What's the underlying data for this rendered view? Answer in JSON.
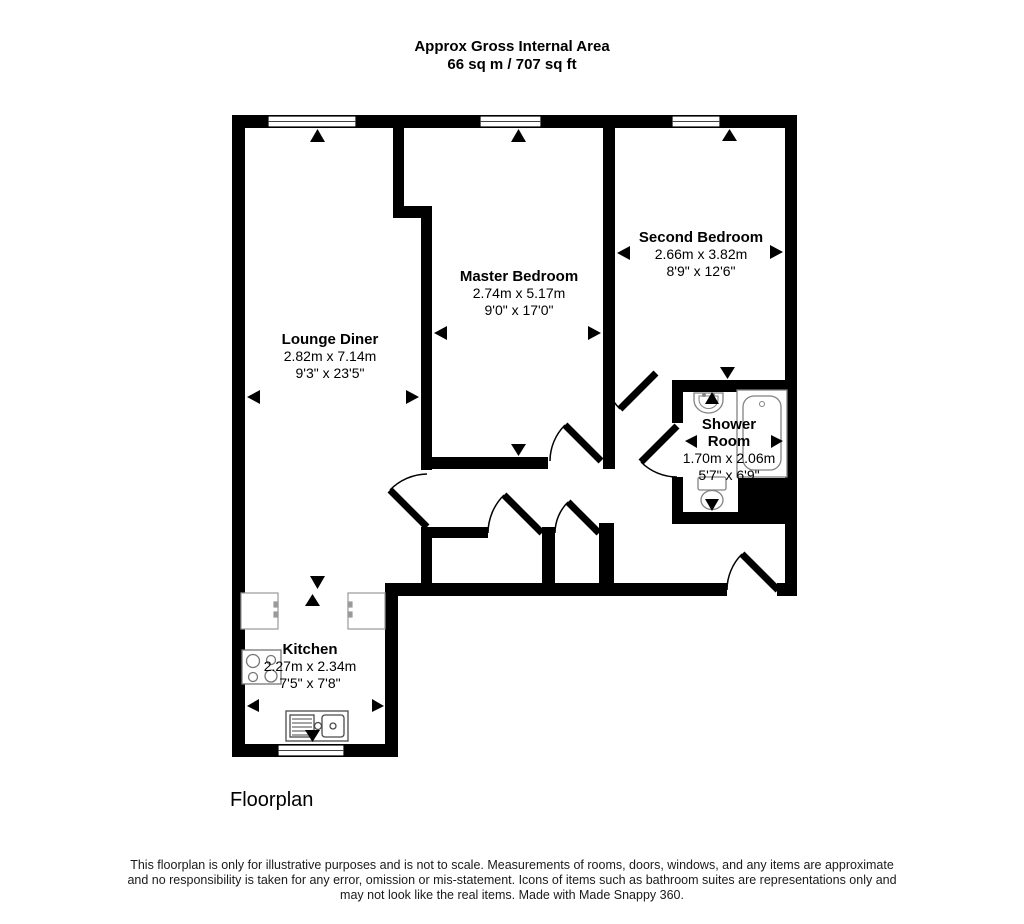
{
  "header": {
    "title": "Approx Gross Internal Area",
    "area": "66 sq m / 707 sq ft"
  },
  "rooms": [
    {
      "name": "Lounge Diner",
      "metric": "2.82m x 7.14m",
      "imperial": "9'3\" x 23'5\""
    },
    {
      "name": "Master Bedroom",
      "metric": "2.74m x 5.17m",
      "imperial": "9'0\" x 17'0\""
    },
    {
      "name": "Second Bedroom",
      "metric": "2.66m x 3.82m",
      "imperial": "8'9\" x 12'6\""
    },
    {
      "name": "Shower Room",
      "metric": "1.70m x 2.06m",
      "imperial": "5'7\" x 6'9\""
    },
    {
      "name": "Kitchen",
      "metric": "2.27m x 2.34m",
      "imperial": "7'5\" x 7'8\""
    }
  ],
  "caption": "Floorplan",
  "disclaimer": [
    "This floorplan is only for illustrative purposes and is not to scale. Measurements of rooms, doors, windows, and any items are approximate",
    "and no responsibility is taken for any error, omission or mis-statement. Icons of items such as bathroom suites are representations only and",
    "may not look like the real items. Made with Made Snappy 360."
  ],
  "colors": {
    "wall": "#000000",
    "background": "#ffffff",
    "fixture_outline": "#8a8a8a"
  }
}
